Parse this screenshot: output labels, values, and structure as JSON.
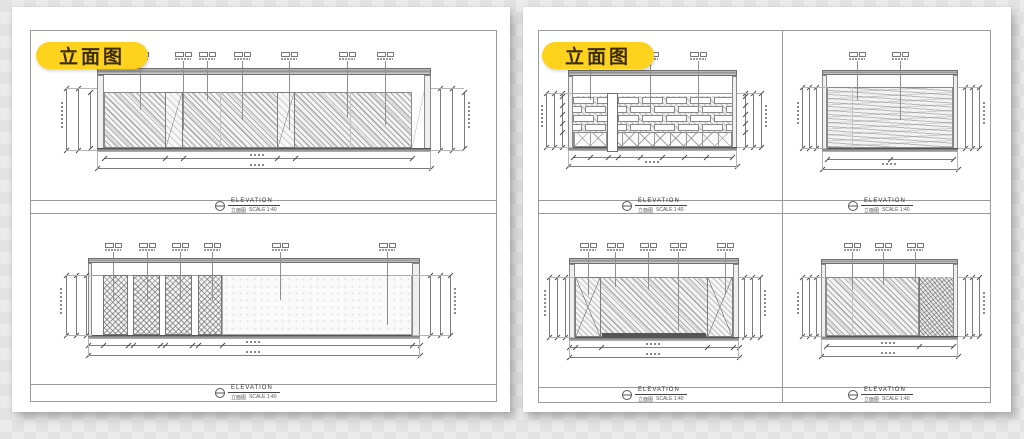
{
  "canvas": {
    "width": 1024,
    "height": 439,
    "background_color": "#e5e5e5"
  },
  "badge": {
    "label": "立面图",
    "background": "#FFD21E",
    "text_color": "#3A2C00"
  },
  "title_block": {
    "name": "ELEVATION",
    "caption": "立面图",
    "scale": "SCALE 1:40"
  },
  "sheets": {
    "left": {
      "drawings": [
        {
          "id": "A",
          "pattern": "diagonal-hatch wall with two door panels",
          "callout_count": 7
        },
        {
          "id": "B",
          "pattern": "four cross-hatched panels with large open panel",
          "callout_count": 6
        }
      ]
    },
    "right": {
      "drawings": [
        {
          "id": "C",
          "pattern": "brick coursing with lattice base and column",
          "callout_count": 3
        },
        {
          "id": "D",
          "pattern": "wood-grain infill wall",
          "callout_count": 2
        },
        {
          "id": "E",
          "pattern": "diagonal-hatch wall with side door panels",
          "callout_count": 5
        },
        {
          "id": "F",
          "pattern": "diagonal-hatch wall with textured end panel",
          "callout_count": 3
        }
      ]
    }
  }
}
